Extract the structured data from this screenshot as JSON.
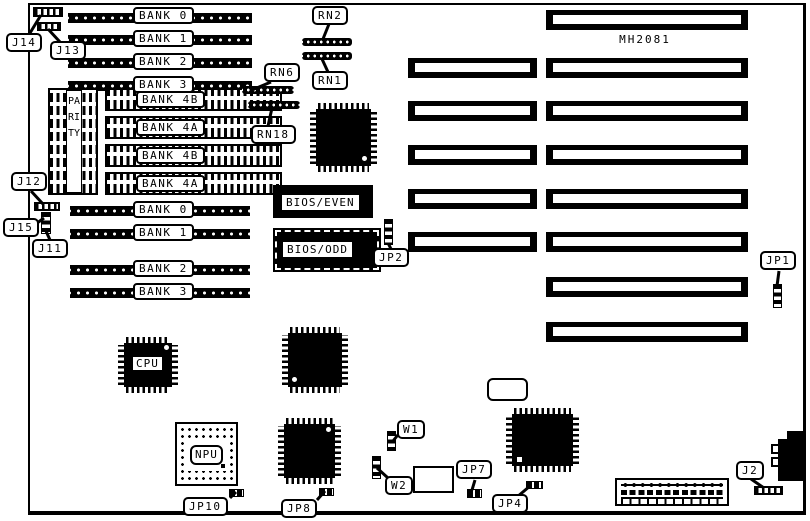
{
  "board_id": "MH2081",
  "memory": {
    "banks_top": [
      "BANK 0",
      "BANK 1",
      "BANK 2",
      "BANK 3"
    ],
    "banks4": [
      "BANK 4B",
      "BANK 4A",
      "BANK 4B",
      "BANK 4A"
    ],
    "banks_mid": [
      "BANK 0",
      "BANK 1",
      "BANK 2",
      "BANK 3"
    ],
    "parity_label": "PARITY"
  },
  "chips": {
    "cpu": "CPU",
    "npu": "NPU",
    "bios_even": "BIOS/EVEN",
    "bios_odd": "BIOS/ODD"
  },
  "resistor_networks": {
    "rn1": "RN1",
    "rn2": "RN2",
    "rn6": "RN6",
    "rn18": "RN18"
  },
  "jumpers": {
    "j2": "J2",
    "j11": "J11",
    "j12": "J12",
    "j13": "J13",
    "j14": "J14",
    "j15": "J15",
    "jp1": "JP1",
    "jp2": "JP2",
    "jp4": "JP4",
    "jp7": "JP7",
    "jp8": "JP8",
    "jp10": "JP10",
    "w1": "W1",
    "w2": "W2"
  },
  "colors": {
    "ink": "#000000",
    "paper": "#ffffff"
  }
}
